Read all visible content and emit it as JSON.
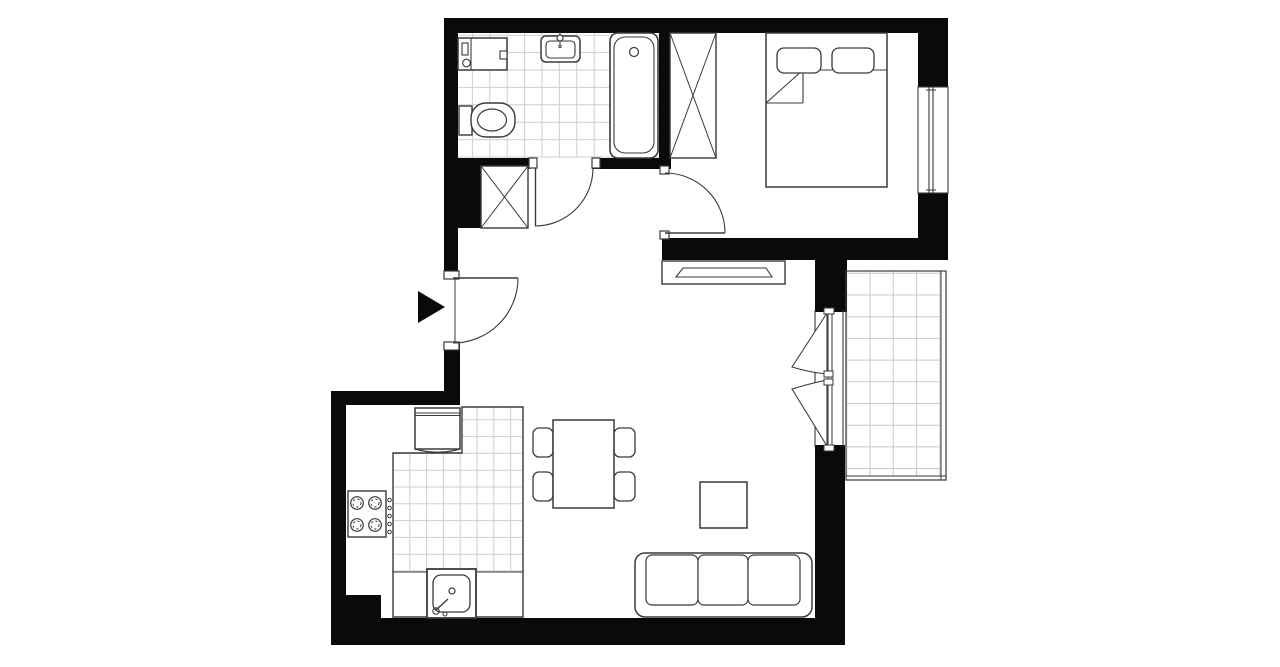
{
  "plan": {
    "w": 1280,
    "h": 667,
    "colors": {
      "bg": "#ffffff",
      "wall": "#0a0a0a",
      "stroke": "#3a3a3a",
      "fill": "#ffffff"
    },
    "walls": [
      {
        "name": "wall-top",
        "r": [
          444,
          18,
          504,
          15
        ]
      },
      {
        "name": "wall-left-upper",
        "r": [
          444,
          18,
          14,
          260
        ]
      },
      {
        "name": "wall-bath-south-left",
        "r": [
          444,
          158,
          86,
          11
        ]
      },
      {
        "name": "wall-bath-south-right",
        "r": [
          592,
          158,
          79,
          11
        ]
      },
      {
        "name": "wall-bath-east",
        "r": [
          659,
          33,
          12,
          136
        ]
      },
      {
        "name": "wall-hall-column",
        "r": [
          458,
          166,
          24,
          62
        ]
      },
      {
        "name": "wall-bedroom-south",
        "r": [
          662,
          238,
          286,
          22
        ]
      },
      {
        "name": "wall-balcony-door-top",
        "r": [
          815,
          260,
          32,
          52
        ]
      },
      {
        "name": "wall-right-upper",
        "r": [
          918,
          33,
          30,
          217
        ]
      },
      {
        "name": "wall-entrance-lower",
        "r": [
          444,
          343,
          16,
          48
        ]
      },
      {
        "name": "wall-kitchen-top",
        "r": [
          331,
          391,
          129,
          14
        ]
      },
      {
        "name": "wall-left-lower",
        "r": [
          331,
          391,
          15,
          254
        ]
      },
      {
        "name": "wall-bottom-left-step",
        "r": [
          346,
          595,
          35,
          23
        ]
      },
      {
        "name": "wall-bottom",
        "r": [
          331,
          618,
          514,
          27
        ]
      },
      {
        "name": "wall-right-lower",
        "r": [
          815,
          445,
          30,
          200
        ]
      }
    ],
    "tiles": [
      {
        "name": "bathroom-floor",
        "poly": [
          [
            458,
            33
          ],
          [
            659,
            33
          ],
          [
            659,
            158
          ],
          [
            458,
            158
          ]
        ],
        "cell": [
          17.4,
          17.4
        ],
        "origin": [
          455,
          35.2
        ],
        "line": "#cfcfcf"
      },
      {
        "name": "kitchen-counter-tiles",
        "poly": [
          [
            462,
            407
          ],
          [
            523,
            407
          ],
          [
            523,
            572
          ],
          [
            393,
            572
          ],
          [
            393,
            453
          ],
          [
            462,
            453
          ]
        ],
        "cell": [
          16.8,
          16.8
        ],
        "origin": [
          393,
          403
        ],
        "line": "#cfcfcf"
      },
      {
        "name": "balcony-floor",
        "poly": [
          [
            846,
            271
          ],
          [
            941,
            271
          ],
          [
            941,
            476
          ],
          [
            846,
            476
          ]
        ],
        "cell": [
          23.3,
          21.7
        ],
        "origin": [
          846.7,
          273.3
        ],
        "line": "#c8c8c8",
        "outline": "#8f8f8f"
      }
    ],
    "items": [
      {
        "name": "balcony-railing",
        "shapes": [
          [
            "re",
            846,
            271,
            100,
            209,
            1.2
          ],
          [
            "ln",
            941,
            271,
            941,
            480,
            1
          ],
          [
            "ln",
            846,
            476,
            946,
            476,
            1
          ]
        ]
      },
      {
        "name": "kitchen-counter-outline",
        "shapes": [
          [
            "pa",
            "M393,453 L462,453 L462,407 L523,407 L523,617 L393,617 Z",
            1.4
          ],
          [
            "ln",
            393,
            572,
            523,
            572,
            1.1
          ]
        ]
      },
      {
        "name": "bedroom-window",
        "shapes": [
          [
            "rw",
            918,
            87,
            30,
            106,
            1.1
          ],
          [
            "ln",
            929,
            87,
            929,
            193,
            1.1
          ],
          [
            "ln",
            933,
            87,
            933,
            193,
            1.1
          ],
          [
            "ln",
            926,
            90,
            936,
            90,
            1
          ],
          [
            "ln",
            926,
            190,
            936,
            190,
            1
          ]
        ]
      },
      {
        "name": "washing-machine",
        "shapes": [
          [
            "rw",
            458,
            38,
            49,
            32,
            1.5
          ],
          [
            "ln",
            471,
            38,
            471,
            70,
            1.1
          ],
          [
            "rw",
            462,
            43,
            6,
            12,
            1.1
          ],
          [
            "co",
            466.5,
            63,
            3.8,
            1.1
          ],
          [
            "rw",
            500,
            51,
            7,
            8,
            1.1
          ]
        ]
      },
      {
        "name": "bathroom-sink",
        "shapes": [
          [
            "rr",
            541,
            36,
            39,
            26,
            5,
            1.5
          ],
          [
            "ro",
            546,
            41,
            29,
            17,
            4,
            1.1
          ],
          [
            "ln",
            560,
            31,
            560,
            45,
            1.1
          ],
          [
            "ci",
            560,
            38,
            3,
            1.2
          ],
          [
            "co",
            560,
            46.5,
            1.2,
            1
          ]
        ]
      },
      {
        "name": "toilet",
        "shapes": [
          [
            "rw",
            459,
            106,
            13,
            29,
            1.4
          ],
          [
            "rr",
            471,
            103,
            44,
            34,
            15,
            1.4
          ],
          [
            "el",
            492,
            120,
            14.5,
            11,
            1.2
          ]
        ]
      },
      {
        "name": "bathtub",
        "shapes": [
          [
            "rr",
            610,
            33,
            48,
            125,
            8,
            1.6
          ],
          [
            "ro",
            614,
            37,
            40,
            116,
            11,
            1.1
          ],
          [
            "co",
            634,
            52,
            4.5,
            1.2
          ]
        ]
      },
      {
        "name": "hall-closet",
        "shapes": [
          [
            "rw",
            481,
            166,
            47,
            62,
            1.4
          ],
          [
            "ln",
            481,
            166,
            528,
            228,
            1
          ],
          [
            "ln",
            528,
            166,
            481,
            228,
            1
          ]
        ]
      },
      {
        "name": "wardrobe",
        "shapes": [
          [
            "rw",
            670,
            33,
            46,
            125,
            1.4
          ],
          [
            "ln",
            670,
            33,
            716,
            158,
            1
          ],
          [
            "ln",
            716,
            33,
            670,
            158,
            1
          ]
        ]
      },
      {
        "name": "bed",
        "shapes": [
          [
            "rw",
            766,
            33,
            121,
            154,
            1.5
          ],
          [
            "ln",
            766,
            103,
            803,
            70,
            1.1
          ],
          [
            "ln",
            766,
            103,
            803,
            103,
            1.1
          ],
          [
            "ln",
            803,
            103,
            803,
            70,
            1.1
          ],
          [
            "ln",
            803,
            70,
            887,
            70,
            1.1
          ],
          [
            "rr",
            777,
            48,
            44,
            25,
            7,
            1.3
          ],
          [
            "rr",
            832,
            48,
            42,
            25,
            7,
            1.3
          ]
        ]
      },
      {
        "name": "tv-stand",
        "shapes": [
          [
            "rw",
            662,
            261,
            123,
            23,
            1.4
          ],
          [
            "pw",
            "M676,277 L683,268 L766,268 L772,277 Z",
            1.1
          ]
        ]
      },
      {
        "name": "dining-set",
        "shapes": [
          [
            "rr",
            533,
            428,
            20,
            29,
            6,
            1.3
          ],
          [
            "rr",
            533,
            472,
            20,
            29,
            6,
            1.3
          ],
          [
            "rr",
            614,
            428,
            21,
            29,
            6,
            1.3
          ],
          [
            "rr",
            614,
            472,
            21,
            29,
            6,
            1.3
          ],
          [
            "rw",
            553,
            420,
            61,
            88,
            1.5
          ]
        ]
      },
      {
        "name": "coffee-table",
        "shapes": [
          [
            "rw",
            700,
            482,
            47,
            46,
            1.5
          ]
        ]
      },
      {
        "name": "sofa",
        "shapes": [
          [
            "rr",
            635,
            553,
            177,
            64,
            10,
            1.5
          ],
          [
            "rr",
            646,
            555,
            52,
            50,
            6,
            1.2
          ],
          [
            "rr",
            698,
            555,
            50,
            50,
            6,
            1.2
          ],
          [
            "rr",
            748,
            555,
            52,
            50,
            6,
            1.2
          ]
        ]
      },
      {
        "name": "stove",
        "shapes": [
          [
            "rw",
            348,
            491,
            38,
            46,
            1.4
          ],
          [
            "co",
            357,
            503,
            6.3,
            1.2
          ],
          [
            "cd",
            357,
            503,
            4
          ],
          [
            "co",
            375,
            503,
            6.3,
            1.2
          ],
          [
            "cd",
            375,
            503,
            4
          ],
          [
            "co",
            357,
            525,
            6.3,
            1.2
          ],
          [
            "cd",
            357,
            525,
            4
          ],
          [
            "co",
            375,
            525,
            6.3,
            1.2
          ],
          [
            "cd",
            375,
            525,
            4
          ],
          [
            "co",
            389.5,
            500,
            1.8,
            1
          ],
          [
            "co",
            389.5,
            508,
            1.8,
            1
          ],
          [
            "co",
            389.5,
            516,
            1.8,
            1
          ],
          [
            "co",
            389.5,
            524,
            1.8,
            1
          ],
          [
            "co",
            389.5,
            532,
            1.8,
            1
          ]
        ]
      },
      {
        "name": "fridge",
        "shapes": [
          [
            "rw",
            415,
            408,
            45,
            41,
            1.5
          ],
          [
            "ln",
            415,
            413,
            460,
            413,
            1
          ],
          [
            "ln",
            415,
            415.5,
            460,
            415.5,
            1
          ],
          [
            "pa",
            "M415,449 Q437.5,455.5 460,449",
            1.2
          ]
        ]
      },
      {
        "name": "kitchen-sink",
        "shapes": [
          [
            "rw",
            427,
            569,
            49,
            49,
            1.8
          ],
          [
            "rr",
            433,
            575,
            37,
            37,
            8,
            1.3
          ],
          [
            "co",
            452,
            591,
            3,
            1.2
          ],
          [
            "pa",
            "M436,610 L448,599",
            1.4
          ],
          [
            "co",
            436,
            611,
            3.2,
            1.1
          ],
          [
            "co",
            445,
            614,
            2,
            1
          ]
        ]
      },
      {
        "name": "door-entrance",
        "shapes": [
          [
            "rw",
            444,
            271,
            15,
            8,
            1.2
          ],
          [
            "rw",
            444,
            342,
            15,
            8,
            1.2
          ],
          [
            "ln",
            455,
            279,
            455,
            342,
            1
          ],
          [
            "ln",
            453,
            278,
            518,
            278,
            1.4
          ],
          [
            "pa",
            "M518,278 A65,65 0 0 1 453,343",
            1.1
          ]
        ]
      },
      {
        "name": "door-bathroom",
        "shapes": [
          [
            "rw",
            529,
            158,
            8,
            10,
            1.2
          ],
          [
            "rw",
            592,
            158,
            8,
            10,
            1.2
          ],
          [
            "ln",
            535.5,
            168,
            535.5,
            226,
            1.4
          ],
          [
            "pa",
            "M593,168 A58,58 0 0 1 535,226",
            1.1
          ]
        ]
      },
      {
        "name": "door-bedroom",
        "shapes": [
          [
            "rw",
            660,
            166,
            9,
            8,
            1.2
          ],
          [
            "rw",
            660,
            231,
            9,
            8,
            1.2
          ],
          [
            "ln",
            665,
            233,
            725,
            233,
            1.4
          ],
          [
            "pa",
            "M725,233 A60,60 0 0 0 665,173",
            1.1
          ]
        ]
      },
      {
        "name": "door-balcony",
        "shapes": [
          [
            "ln",
            815,
            310,
            815,
            447,
            1.1
          ],
          [
            "ln",
            843,
            310,
            843,
            447,
            1.1
          ],
          [
            "ln",
            828,
            313,
            828,
            446,
            1
          ],
          [
            "ln",
            832,
            313,
            832,
            446,
            1
          ],
          [
            "pw",
            "M827,313 L792,367 Q810,372.5 827,374 Z",
            1.1
          ],
          [
            "pw",
            "M827,446 L792,389 Q810,383.5 827,380 Z",
            1.1
          ],
          [
            "rw",
            824,
            371,
            9,
            6,
            1
          ],
          [
            "rw",
            824,
            379,
            9,
            6,
            1
          ],
          [
            "rw",
            824,
            308,
            10,
            6,
            1
          ],
          [
            "rw",
            824,
            445,
            10,
            6,
            1
          ]
        ]
      },
      {
        "name": "entrance-arrow",
        "shapes": [
          [
            "pb",
            "M418,291 L445,307 L418,323 Z"
          ]
        ]
      }
    ]
  }
}
